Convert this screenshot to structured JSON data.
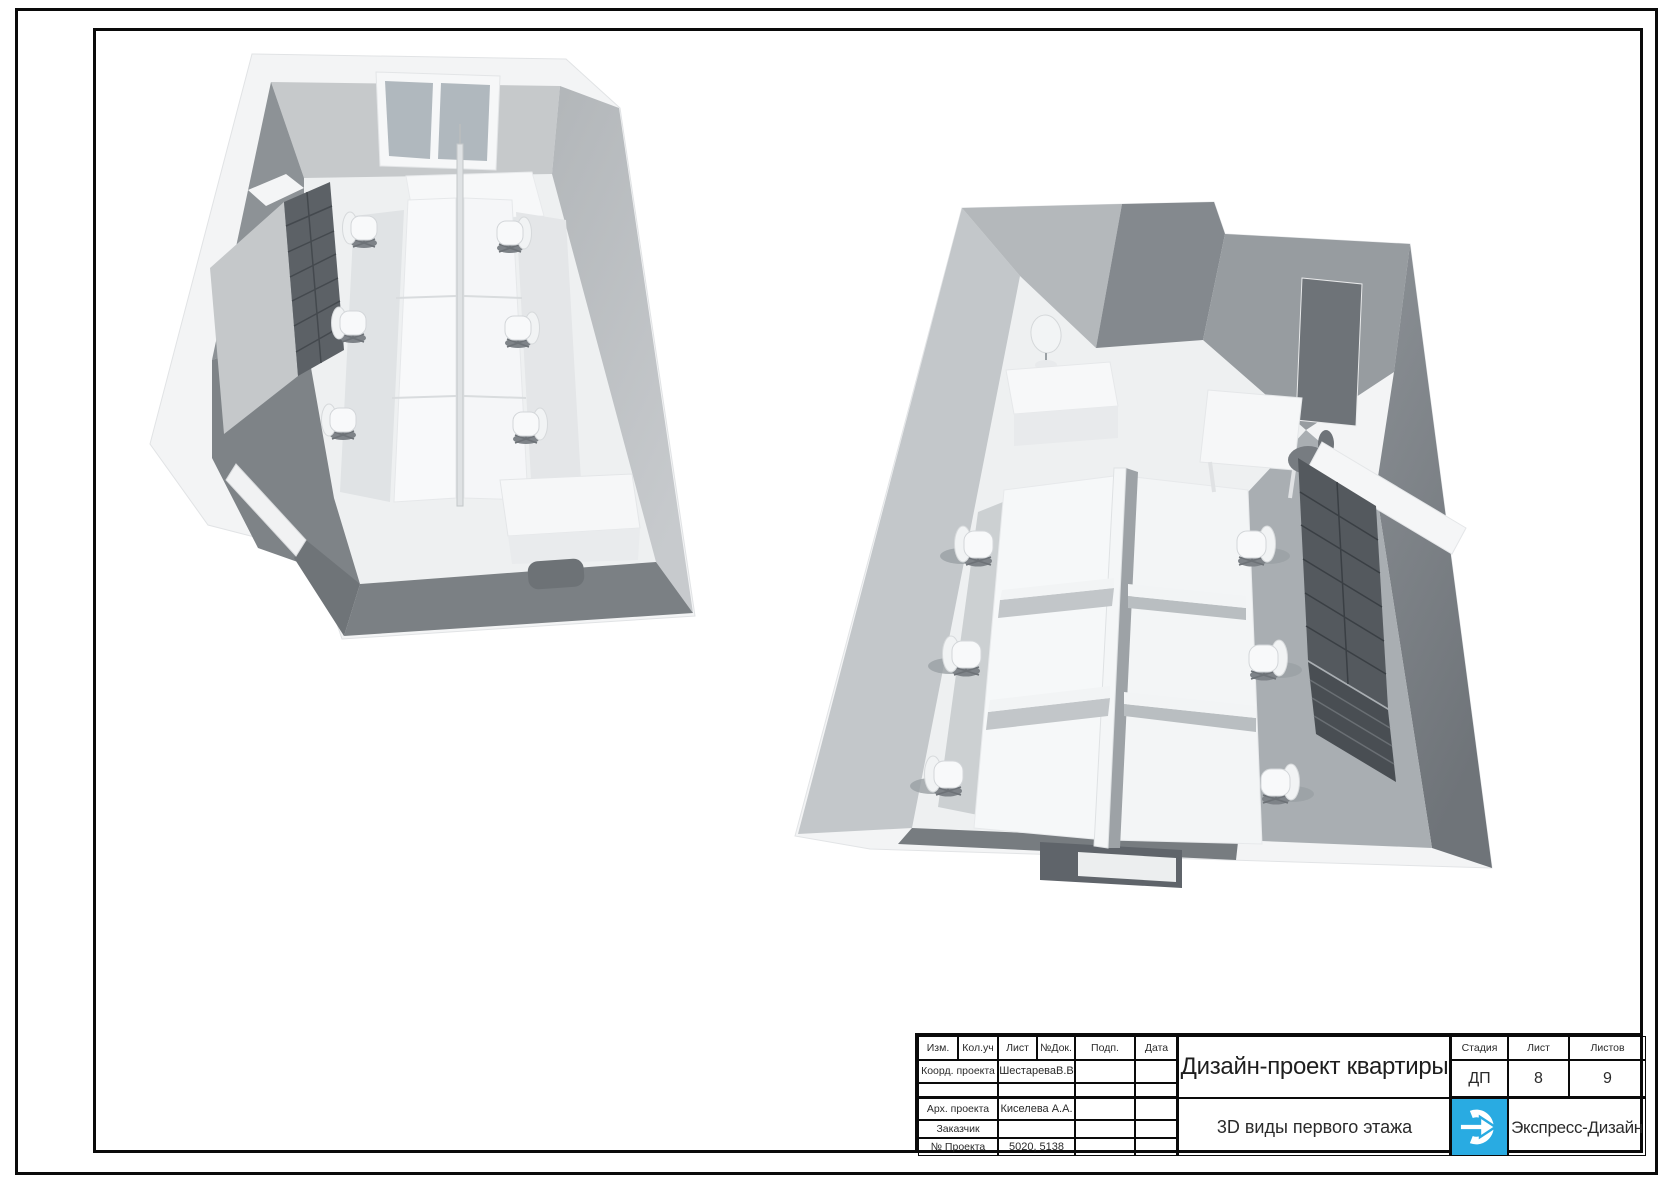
{
  "palette": {
    "logo_blue": "#29abe2",
    "frame": "#0a0a0a",
    "wall_light": "#c3c7ca",
    "wall_dark": "#84898e",
    "floor": "#eef0f1"
  },
  "title_block": {
    "header_columns": [
      "Изм.",
      "Кол.уч",
      "Лист",
      "№Док.",
      "Подп.",
      "Дата"
    ],
    "rows": [
      {
        "label": "Коорд. проекта",
        "value": "ШестареваВ.В"
      },
      {
        "label": "",
        "value": ""
      },
      {
        "label": "Арх. проекта",
        "value": "Киселева А.А."
      },
      {
        "label": "Заказчик",
        "value": ""
      },
      {
        "label": "№ Проекта",
        "value": "5020, 5138"
      }
    ],
    "project_title": "Дизайн-проект квартиры",
    "sheet_title": "3D виды первого этажа",
    "stage": {
      "label": "Стадия",
      "value": "ДП"
    },
    "sheet": {
      "label": "Лист",
      "value": "8"
    },
    "sheets_total": {
      "label": "Листов",
      "value": "9"
    },
    "company": "Экспресс-Дизайн"
  }
}
